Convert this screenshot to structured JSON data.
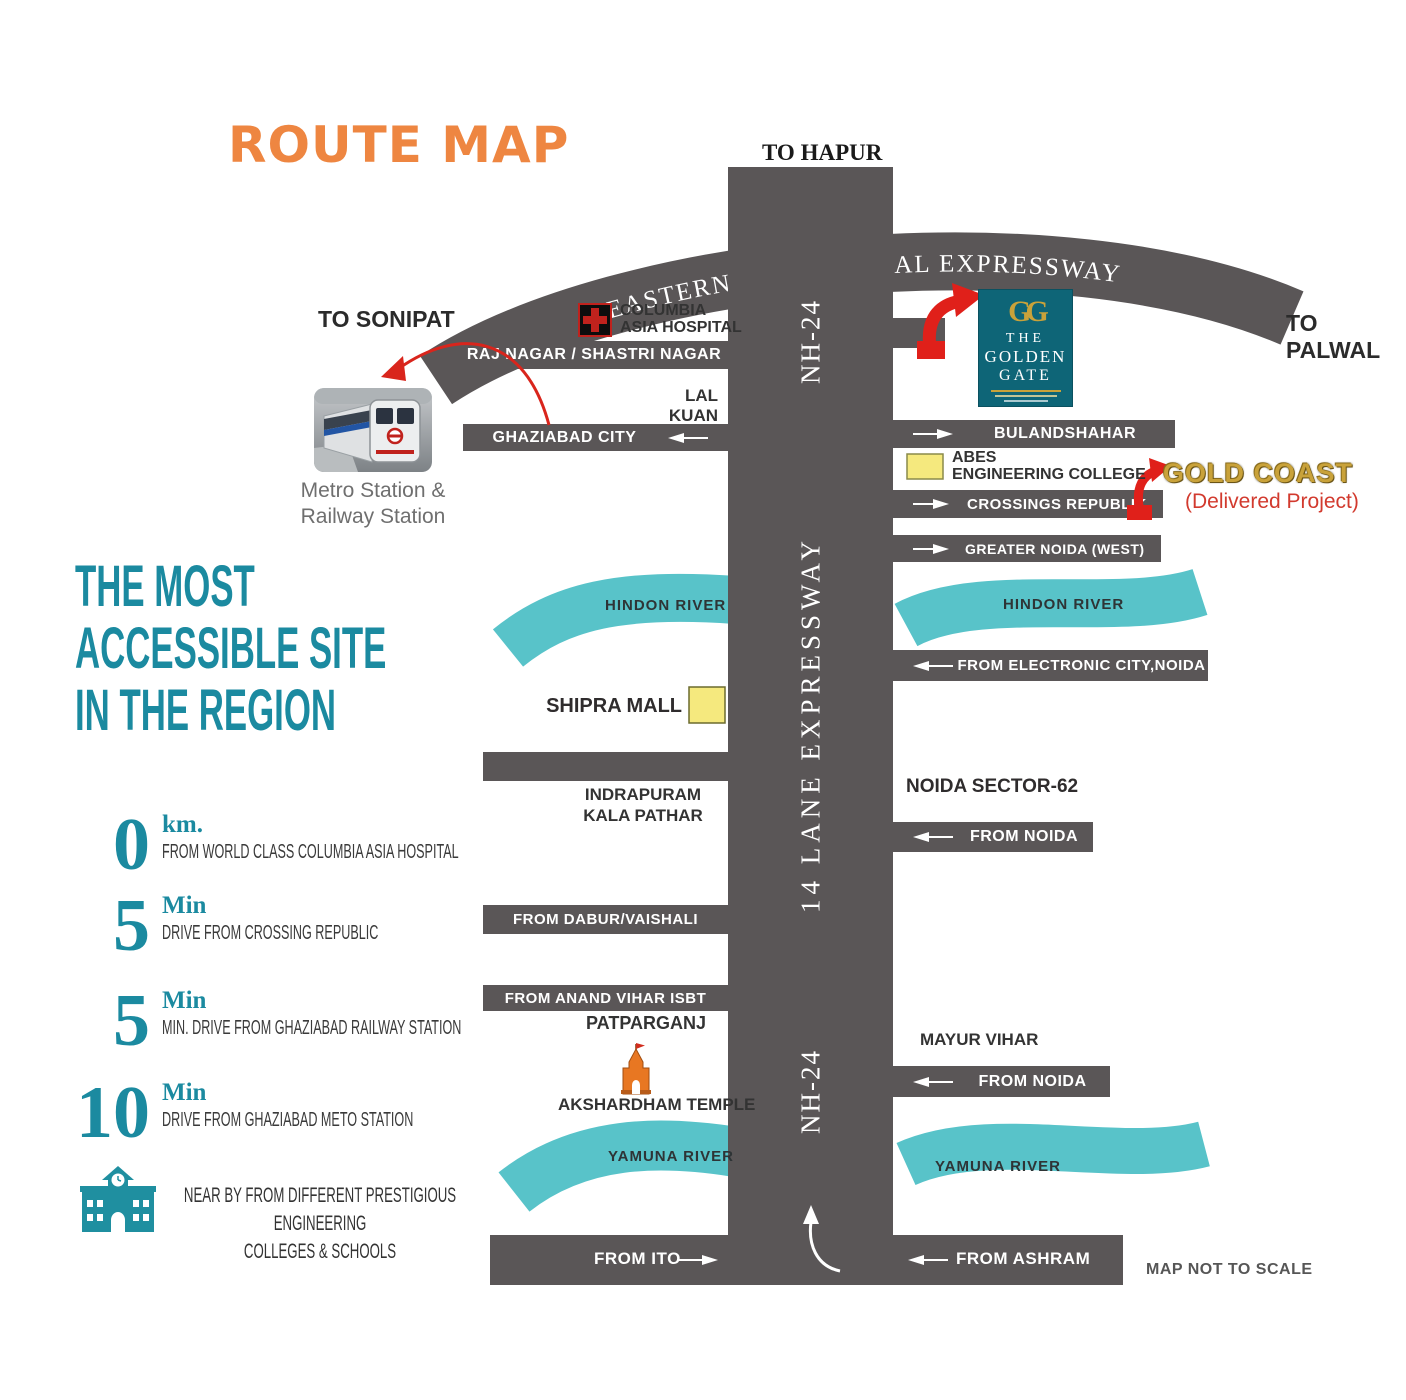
{
  "header": {
    "title": "ROUTE MAP"
  },
  "directions": {
    "hapur": "TO HAPUR",
    "sonipat": "TO SONIPAT",
    "palwal": "TO PALWAL"
  },
  "expressway": {
    "arc_label": "EASTERN PHERIPHERAL EXPRESSWAY",
    "nh24_top": "NH-24",
    "nh24_bottom": "NH-24",
    "lane14": "14 LANE EXPRESSWAY"
  },
  "roads": {
    "raj_nagar": "RAJ NAGAR / SHASTRI NAGAR",
    "ghaziabad_city": "GHAZIABAD CITY",
    "bulandshahar": "BULANDSHAHAR",
    "crossings_republik": "CROSSINGS REPUBLIK",
    "greater_noida_west": "GREATER NOIDA (WEST)",
    "from_electronic_city": "FROM ELECTRONIC CITY,NOIDA",
    "from_noida_1": "FROM NOIDA",
    "from_noida_2": "FROM NOIDA",
    "from_dabur": "FROM DABUR/VAISHALI",
    "from_anand_vihar": "FROM ANAND VIHAR ISBT",
    "from_ito": "FROM ITO",
    "from_ashram": "FROM ASHRAM"
  },
  "places": {
    "columbia_line1": "COLUMBIA",
    "columbia_line2": "ASIA HOSPITAL",
    "lal_kuan_l1": "LAL",
    "lal_kuan_l2": "KUAN",
    "metro_caption_l1": "Metro Station &",
    "metro_caption_l2": "Railway Station",
    "abes_l1": "ABES",
    "abes_l2": "ENGINEERING COLLEGE",
    "shipra_mall": "SHIPRA MALL",
    "indrapuram_l1": "INDRAPURAM",
    "indrapuram_l2": "KALA PATHAR",
    "noida_sector": "NOIDA SECTOR-62",
    "mayur_vihar": "MAYUR VIHAR",
    "patparganj": "PATPARGANJ",
    "akshardham": "AKSHARDHAM TEMPLE",
    "hindon_left": "HINDON RIVER",
    "hindon_right": "HINDON RIVER",
    "yamuna_left": "YAMUNA RIVER",
    "yamuna_right": "YAMUNA RIVER"
  },
  "logos": {
    "golden_gate": {
      "monogram": "GG",
      "l1": "THE",
      "l2": "GOLDEN",
      "l3": "GATE"
    },
    "gold_coast": {
      "name": "GOLD COAST",
      "sub": "(Delivered Project)"
    }
  },
  "sidebar": {
    "heading_l1": "THE MOST",
    "heading_l2": "ACCESSIBLE SITE",
    "heading_l3": "IN THE REGION",
    "stats": [
      {
        "value": "0",
        "unit": "km.",
        "desc": "FROM WORLD CLASS COLUMBIA ASIA HOSPITAL"
      },
      {
        "value": "5",
        "unit": "Min",
        "desc": "DRIVE FROM CROSSING REPUBLIC"
      },
      {
        "value": "5",
        "unit": "Min",
        "desc": "MIN. DRIVE FROM GHAZIABAD RAILWAY STATION"
      },
      {
        "value": "10",
        "unit": "Min",
        "desc": "DRIVE FROM GHAZIABAD METO STATION"
      }
    ],
    "note_l1": "NEAR BY FROM DIFFERENT PRESTIGIOUS ENGINEERING",
    "note_l2": "COLLEGES & SCHOOLS"
  },
  "footer": {
    "scale_note": "MAP NOT TO SCALE"
  },
  "colors": {
    "road": "#5a5657",
    "river": "#58c3c9",
    "teal": "#1b8aa0",
    "orange": "#ee8641",
    "red": "#e0201a"
  }
}
